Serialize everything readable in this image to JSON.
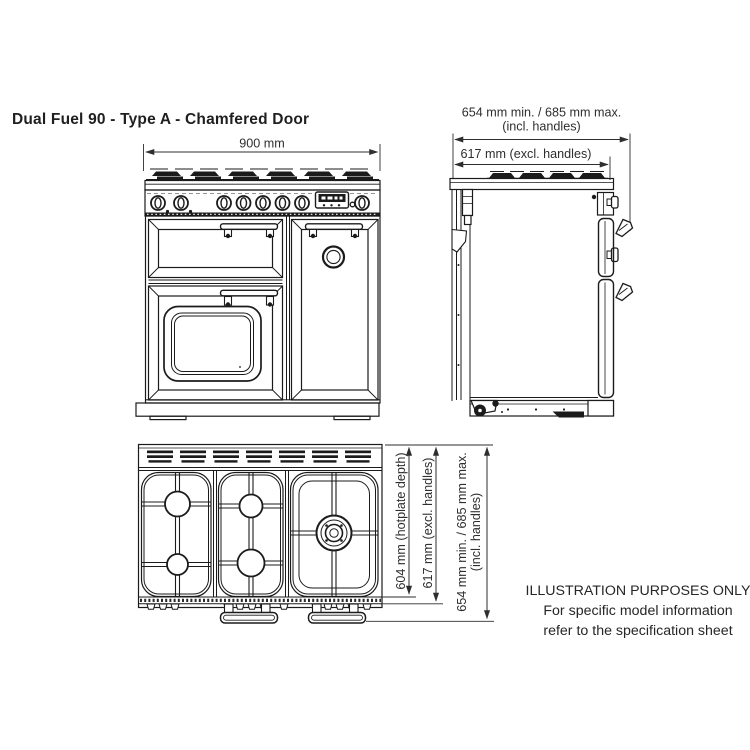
{
  "title": "Dual Fuel 90 - Type A - Chamfered Door",
  "front_view": {
    "width": "900 mm"
  },
  "side_view": {
    "depth_incl_handles": "654 mm min. / 685 mm max.",
    "incl_handles_note": "(incl. handles)",
    "depth_excl_handles": "617 mm (excl. handles)"
  },
  "top_view": {
    "hotplate_depth": "604 mm (hotplate depth)",
    "depth_excl_handles": "617 mm (excl. handles)",
    "depth_incl_handles": "654 mm min. / 685 mm max.",
    "incl_handles_note": "(incl. handles)"
  },
  "disclaimer": {
    "line1": "ILLUSTRATION PURPOSES ONLY",
    "line2": "For specific model information",
    "line3": "refer to the specification sheet"
  },
  "colors": {
    "line": "#1b1b1b",
    "dimension": "#2e2e2e",
    "background": "#ffffff"
  }
}
